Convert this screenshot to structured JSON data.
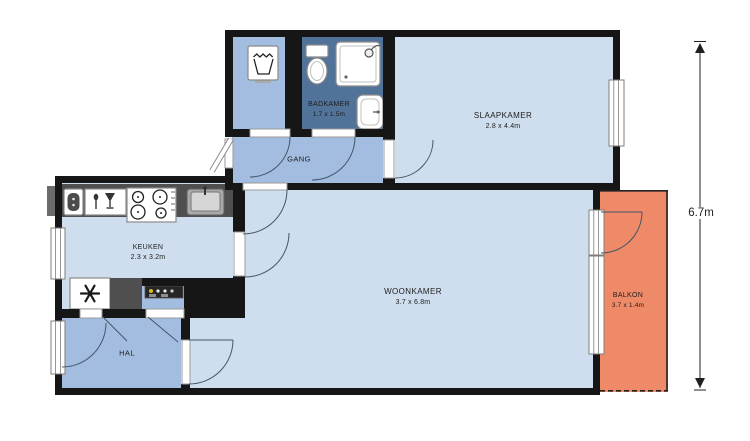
{
  "colors": {
    "wall": "#161616",
    "room_light": "#cedeef",
    "room_medium": "#a2bddf",
    "room_dark": "#527399",
    "balcony": "#ee8a67",
    "counter": "#4f4f4f",
    "door_line": "#44566b",
    "window_frame": "#7d7d7d",
    "fixture_stroke": "#8a8a8a",
    "dim_line": "#1f1f1f",
    "label": "#1d1d1d"
  },
  "rooms": {
    "badkamer": {
      "name": "BADKAMER",
      "dims": "1.7 x 1.5m"
    },
    "gang": {
      "name": "GANG"
    },
    "slaapkamer": {
      "name": "SLAAPKAMER",
      "dims": "2.8 x 4.4m"
    },
    "keuken": {
      "name": "KEUKEN",
      "dims": "2.3 x 3.2m"
    },
    "woonkamer": {
      "name": "WOONKAMER",
      "dims": "3.7 x 6.8m"
    },
    "hal": {
      "name": "HAL"
    },
    "balkon": {
      "name": "BALKON",
      "dims": "3.7 x 1.4m"
    }
  },
  "dimension": {
    "height_label": "6.7m"
  },
  "icons": {
    "laundry": "wash-tub-glyph",
    "toilet": "toilet-glyph",
    "shower": "shower-glyph",
    "washbasin": "washbasin-glyph",
    "water_heater": "boiler-glyph",
    "dishwasher": "cutlery-glass-glyph",
    "stove": "four-burner-glyph",
    "kitchen_sink": "sink-glyph",
    "fridge": "asterisk-snowflake-glyph",
    "meter_panel": "electric-meter-glyph"
  }
}
